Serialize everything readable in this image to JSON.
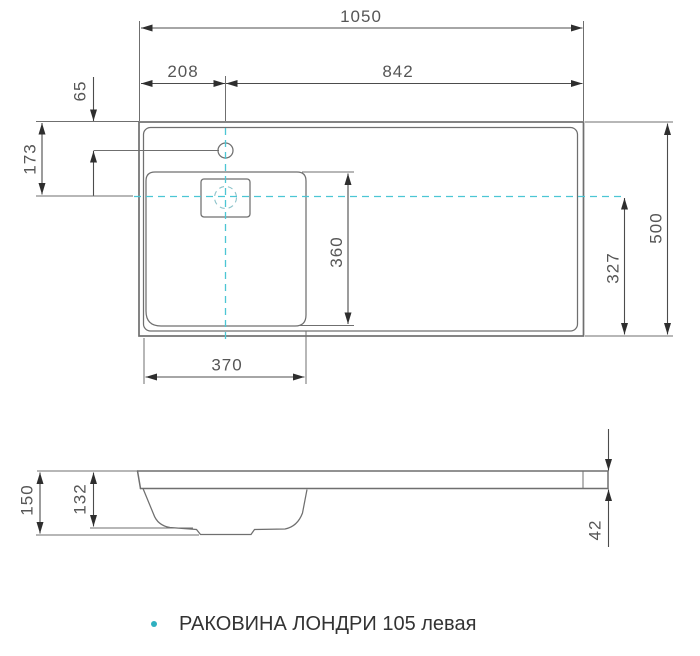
{
  "drawing": {
    "caption": {
      "text": "РАКОВИНА ЛОНДРИ 105 левая"
    },
    "top_view": {
      "dims": {
        "overall_width": "1050",
        "faucet_from_left": "208",
        "faucet_to_right": "842",
        "faucet_from_top_edge": "65",
        "basin_center_from_top": "173",
        "overall_depth": "500",
        "basin_center_to_bottom": "327",
        "basin_width": "370",
        "basin_length": "360"
      }
    },
    "side_view": {
      "dims": {
        "overall_height": "150",
        "bowl_depth": "132",
        "rim_thickness": "42"
      }
    },
    "colors": {
      "object_line": "#6f6f6f",
      "dimension_line": "#4c4c4c",
      "dimension_text": "#565656",
      "centerline": "#4cc6d4",
      "bullet": "#2fb0c0",
      "background": "#ffffff"
    }
  }
}
